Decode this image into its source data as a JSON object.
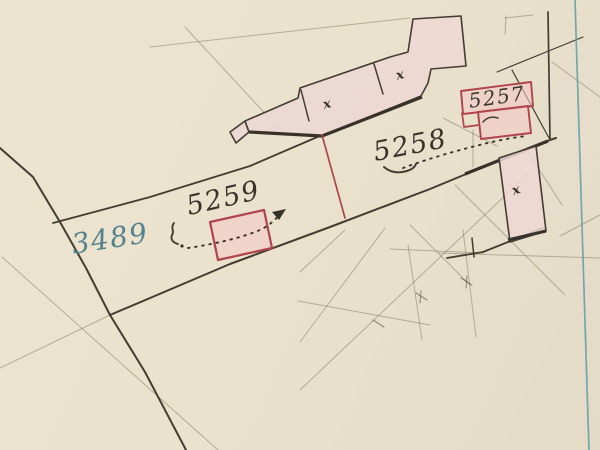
{
  "map": {
    "kind": "cadastral-plan-scan",
    "parcel_labels": [
      {
        "id": "parcel-3489",
        "text": "3489",
        "color": "#54828f"
      },
      {
        "id": "parcel-5259",
        "text": "5259",
        "color": "#38332b"
      },
      {
        "id": "parcel-5258",
        "text": "5258",
        "color": "#38332b"
      },
      {
        "id": "parcel-5257",
        "text": "5257",
        "color": "#38332b"
      }
    ],
    "building_marks": {
      "symbol": "x",
      "count": 3
    },
    "colors": {
      "paper": "#eae2cd",
      "ink": "#433d33",
      "pencil": "#6b6148",
      "annotation_red": "#b0444c",
      "building_fill": "#edd7d3",
      "survey_line_blue": "#5f9dab",
      "label_blue": "#54828f",
      "label_ink": "#38332b"
    }
  }
}
